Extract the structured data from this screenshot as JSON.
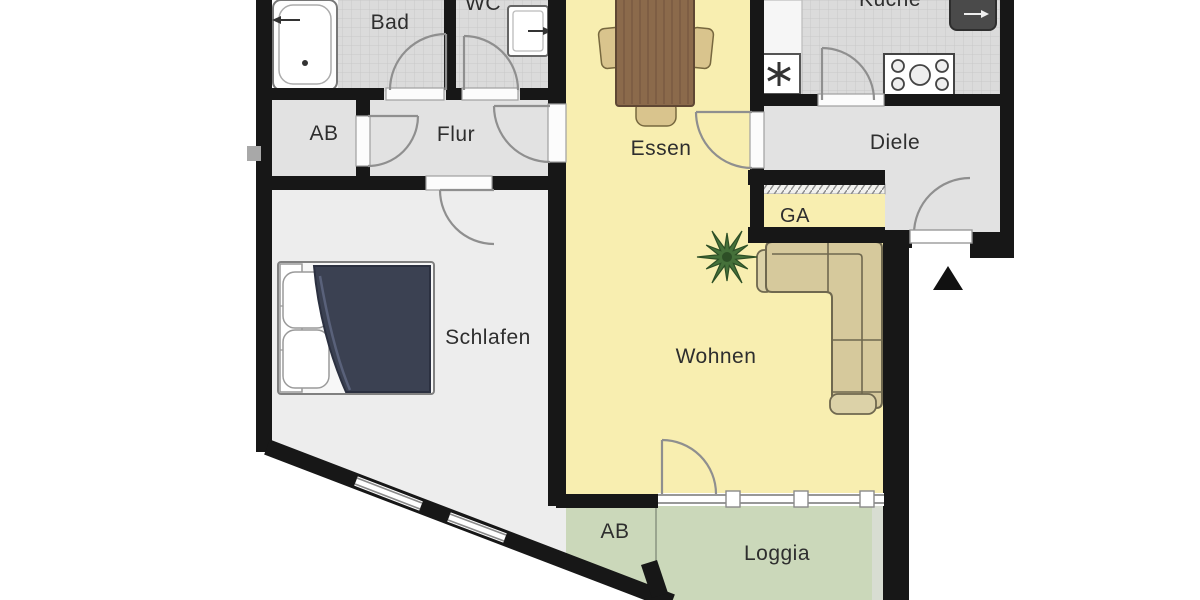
{
  "floorplan": {
    "rooms": {
      "bad": {
        "label": "Bad",
        "floor": "tiled-gray"
      },
      "wc": {
        "label": "WC",
        "floor": "tiled-gray"
      },
      "ab_upper": {
        "label": "AB",
        "floor": "gray"
      },
      "flur": {
        "label": "Flur",
        "floor": "gray"
      },
      "essen": {
        "label": "Essen",
        "floor": "yellow"
      },
      "kueche": {
        "label": "Küche",
        "floor": "tiled-gray"
      },
      "diele": {
        "label": "Diele",
        "floor": "gray"
      },
      "ga": {
        "label": "GA",
        "floor": "yellow"
      },
      "schlafen": {
        "label": "Schlafen",
        "floor": "light-gray"
      },
      "wohnen": {
        "label": "Wohnen",
        "floor": "yellow"
      },
      "ab_lower": {
        "label": "AB",
        "floor": "green"
      },
      "loggia": {
        "label": "Loggia",
        "floor": "green"
      }
    },
    "colors": {
      "wall": "#171717",
      "room_yellow": "#f8eeb0",
      "room_green": "#cbd8ba",
      "room_gray": "#e2e2e2",
      "schlafen_gray": "#ededed",
      "tile_gray": "#dbdbdb",
      "sofa_tan": "#d6c99c",
      "table_brown": "#8b6a4b",
      "bed_duvet_navy": "#3b4152",
      "plant_green": "#45713a"
    },
    "furniture": [
      "bathtub",
      "wc-sink",
      "dining-table",
      "dining-chairs",
      "dishwasher",
      "stove",
      "kitchen-sink",
      "wardrobe",
      "sofa",
      "plant",
      "double-bed"
    ],
    "markers": {
      "entrance_arrow": "black triangle pointing up at apartment entrance"
    }
  }
}
